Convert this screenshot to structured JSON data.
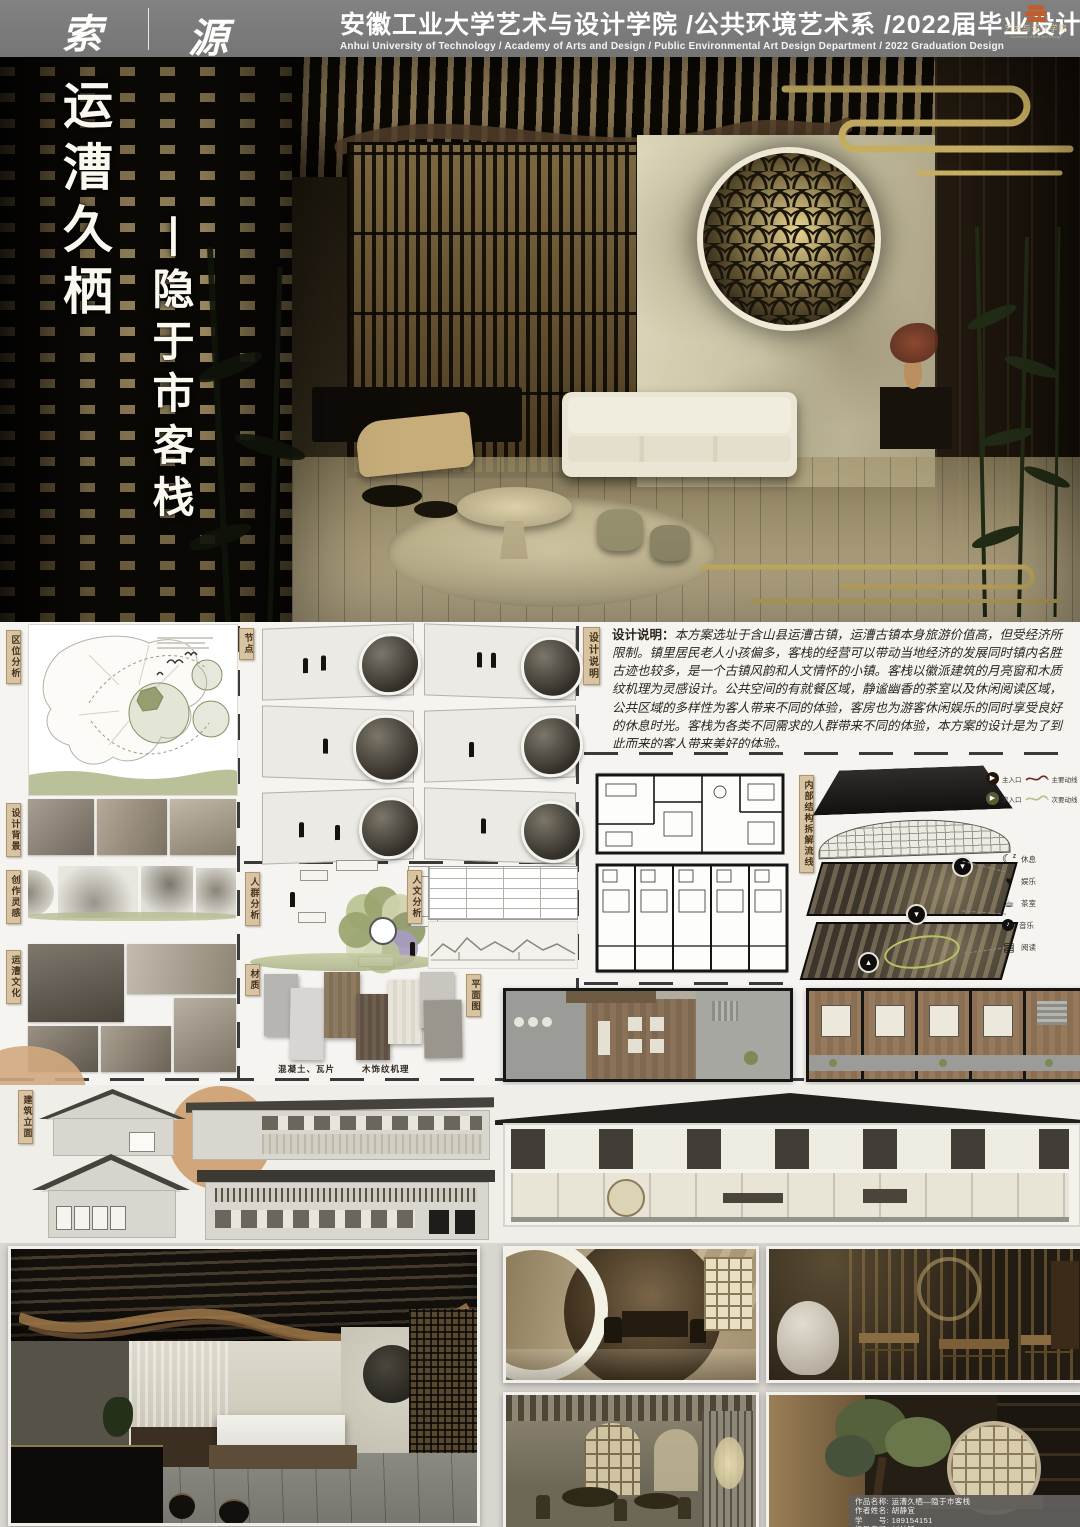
{
  "header": {
    "logo_left": "索",
    "logo_right": "源",
    "title_cn": "安徽工业大学艺术与设计学院 /公共环境艺术系 /2022届毕业设计",
    "title_en": "Anhui University of Technology / Academy of Arts and Design / Public Environmental Art Design Department / 2022 Graduation Design",
    "badge_cn": "艺术与设计学院",
    "badge_en": "Academy of Arts and Design"
  },
  "hero": {
    "vertical_title_main": "运漕久栖",
    "vertical_title_sub": "丨隐于市客栈"
  },
  "tags": {
    "location": "区位分析",
    "background": "设计背景",
    "inspiration": "创作灵感",
    "culture": "运漕文化",
    "nodes": "节点",
    "crowd": "人群分析",
    "material": "材质",
    "humanities": "人文分析",
    "plan": "平面图",
    "statement": "设计说明",
    "structure": "内部结构拆解流线",
    "elevation": "建筑立面"
  },
  "statement": {
    "label": "设计说明：",
    "text": "本方案选址于含山县运漕古镇，运漕古镇本身旅游价值高，但受经济所限制。镇里居民老人小孩偏多，客栈的经营可以带动当地经济的发展同时镇内名胜古迹也较多，是一个古镇风韵和人文情怀的小镇。客栈以徽派建筑的月亮窗和木质纹机理为灵感设计。公共空间的有就餐区域，静谧幽香的茶室以及休闲阅读区域，公共区域的多样性为客人带来不同的体验，客房也为游客休闲娱乐的同时享受良好的休息时光。客栈为各类不同需求的人群带来不同的体验，本方案的设计是为了到此而来的客人带来美好的体验。"
  },
  "materials": {
    "caption_concrete": "混凝土、瓦片",
    "caption_wood": "木饰纹机理"
  },
  "legend": {
    "main_entrance": "主入口",
    "sub_entrance": "次入口",
    "main_route": "主要动线",
    "sub_route": "次要动线",
    "functions": [
      {
        "icon": "moon-rest-icon",
        "label": "休息"
      },
      {
        "icon": "game-heart-icon",
        "label": "娱乐"
      },
      {
        "icon": "tea-cup-icon",
        "label": "茶室"
      },
      {
        "icon": "music-disc-icon",
        "label": "音乐"
      },
      {
        "icon": "book-icon",
        "label": "阅读"
      }
    ]
  },
  "colors": {
    "accent_tan": "#d2a87e",
    "tag_bg": "#d8c4a2",
    "gold_cloud": "#c6ae62",
    "route_main": "#6e2a22",
    "route_sub": "#b9bd8a",
    "olive": "#aab387",
    "header_gray": "#7b7b7b"
  },
  "credits": {
    "work_label": "作品名称:",
    "work_value": "运漕久栖—隐于市客栈",
    "author_label": "作者姓名:",
    "author_value": "胡静宜",
    "id_label": "学　　号:",
    "id_value": "189154151",
    "tutor_label": "指导老师:",
    "tutor_value": "刘林钰"
  }
}
